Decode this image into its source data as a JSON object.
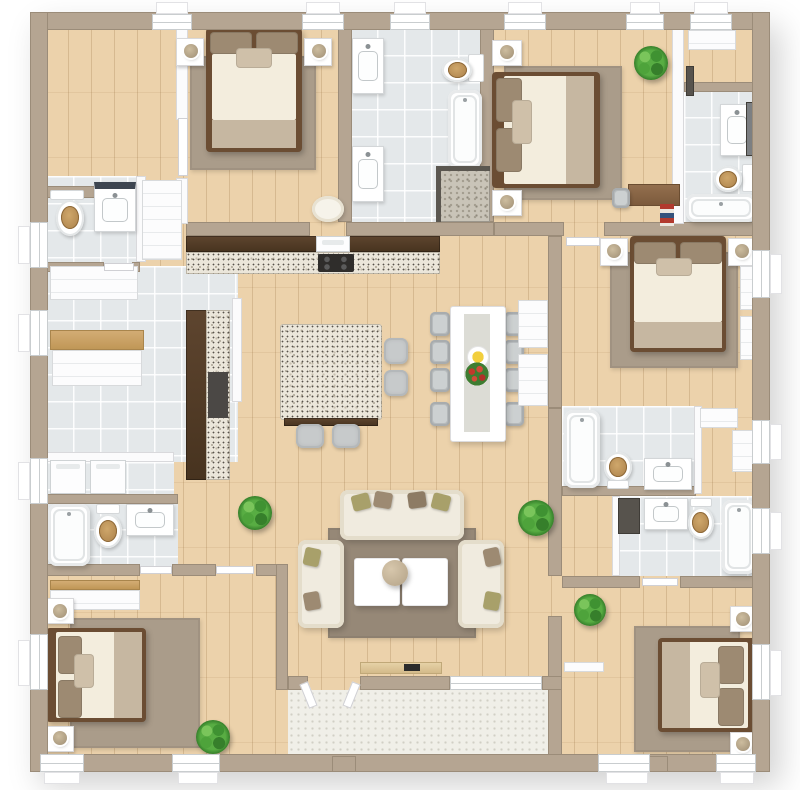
{
  "scene": {
    "type": "3d-floor-plan-top-view",
    "description": "Rendered 3D overhead floor plan of a 5-bedroom house with open-plan kitchen, dining and living area, six bath/washrooms, entry mudroom with laundry, and rear patio. No text labels are rendered in the image.",
    "background": "#ffffff"
  },
  "palette": {
    "wood": "#ecd2ab",
    "tile": "#e4e8ea",
    "wall": "#b5a592",
    "wallEdge": "#8f8170",
    "cream": "#f3eddd",
    "bedFrame": "#6b4d33",
    "blanket": "#c6b7a1",
    "pillow": "#9d8a72",
    "pillowLight": "#cfc0a9",
    "rugLiving": "#968877",
    "rugBedroom": "#aa9c8a",
    "sofa": "#f0ebdf",
    "cushionOlive": "#a8a06a",
    "cushionTaupe": "#9d8a72",
    "darkWood": "#523b27",
    "granite": "#ebe6da",
    "woodSeat": "#c49a5f",
    "chairGray": "#b6babc",
    "plantGreen": "#4ea33b",
    "patio": "#f0efe8",
    "benchWood": "#c9a26a"
  },
  "rooms": [
    {
      "id": "office",
      "name": "walk-in-closet-or-office",
      "floor": "wood",
      "furniture": []
    },
    {
      "id": "bedroom-1",
      "name": "bedroom-top-left",
      "floor": "wood",
      "furniture": [
        "double-bed",
        "2-nightstands",
        "2-lamps",
        "area-rug",
        "round-pouf"
      ]
    },
    {
      "id": "bathroom-central",
      "name": "family-bathroom-top-center",
      "floor": "tile",
      "furniture": [
        "2-vanity-sinks",
        "toilet",
        "bathtub",
        "walk-in-shower"
      ]
    },
    {
      "id": "bedroom-2",
      "name": "bedroom-top-right",
      "floor": "wood",
      "furniture": [
        "double-bed",
        "2-nightstands",
        "2-lamps",
        "area-rug",
        "desk",
        "desk-chair",
        "books",
        "plant"
      ]
    },
    {
      "id": "hall-top-right",
      "name": "hallway-nook-top-right",
      "floor": "wood",
      "furniture": [
        "closet",
        "wall-panel"
      ]
    },
    {
      "id": "bathroom-top-right",
      "name": "ensuite-bathroom-top-right",
      "floor": "tile",
      "furniture": [
        "vanity-sink",
        "mirror",
        "toilet",
        "bathtub"
      ]
    },
    {
      "id": "powder-room",
      "name": "powder-room-left",
      "floor": "tile",
      "furniture": [
        "toilet",
        "vanity-sink",
        "closet"
      ]
    },
    {
      "id": "entry",
      "name": "entry-mudroom-left",
      "floor": "tile",
      "furniture": [
        "cabinets",
        "storage-bench",
        "washer",
        "dryer"
      ]
    },
    {
      "id": "kitchen",
      "name": "open-plan-kitchen",
      "floor": "wood",
      "furniture": [
        "wall-counter-granite",
        "oven",
        "cooktop",
        "side-counter-granite",
        "island-granite",
        "4-bar-stools"
      ]
    },
    {
      "id": "dining",
      "name": "dining-area",
      "floor": "wood",
      "furniture": [
        "table-for-8",
        "8-chairs",
        "centerpiece-plate",
        "flower-bouquet"
      ]
    },
    {
      "id": "living",
      "name": "living-room",
      "floor": "wood",
      "furniture": [
        "3-piece-sofa-set",
        "8-cushions",
        "2-coffee-tables",
        "pendant-ball",
        "area-rug",
        "console-table",
        "2-plants"
      ]
    },
    {
      "id": "bathroom-bottom-left",
      "name": "bathroom-bottom-left",
      "floor": "tile",
      "furniture": [
        "bathtub",
        "toilet",
        "vanity-sink"
      ]
    },
    {
      "id": "bedroom-4",
      "name": "bedroom-bottom-left",
      "floor": "wood",
      "furniture": [
        "double-bed",
        "2-nightstands",
        "2-lamps",
        "area-rug",
        "dresser",
        "plant"
      ]
    },
    {
      "id": "bedroom-3",
      "name": "bedroom-right-middle",
      "floor": "wood",
      "furniture": [
        "double-bed",
        "2-nightstands",
        "2-lamps",
        "area-rug",
        "2-dressers"
      ]
    },
    {
      "id": "bathroom-right-upper",
      "name": "bathroom-right-upper",
      "floor": "tile",
      "furniture": [
        "bathtub",
        "toilet",
        "vanity-sink",
        "closet-nook-2-dressers"
      ]
    },
    {
      "id": "bathroom-right-lower",
      "name": "bathroom-right-lower",
      "floor": "tile",
      "furniture": [
        "dark-shelf",
        "vanity-sink",
        "toilet",
        "bathtub"
      ]
    },
    {
      "id": "bedroom-5",
      "name": "bedroom-bottom-right",
      "floor": "wood",
      "furniture": [
        "double-bed",
        "2-nightstands",
        "2-lamps",
        "area-rug",
        "wall-shelf",
        "plant"
      ]
    },
    {
      "id": "patio",
      "name": "patio-terrace-bottom-center",
      "floor": "pavers",
      "furniture": [
        "open-french-doors",
        "2-piers"
      ]
    }
  ],
  "counts": {
    "bedrooms": 5,
    "bathrooms": 6,
    "toilets": 6,
    "bathtubs": 6,
    "plants": 5,
    "dining_seats": 8,
    "bar_stools": 4
  }
}
